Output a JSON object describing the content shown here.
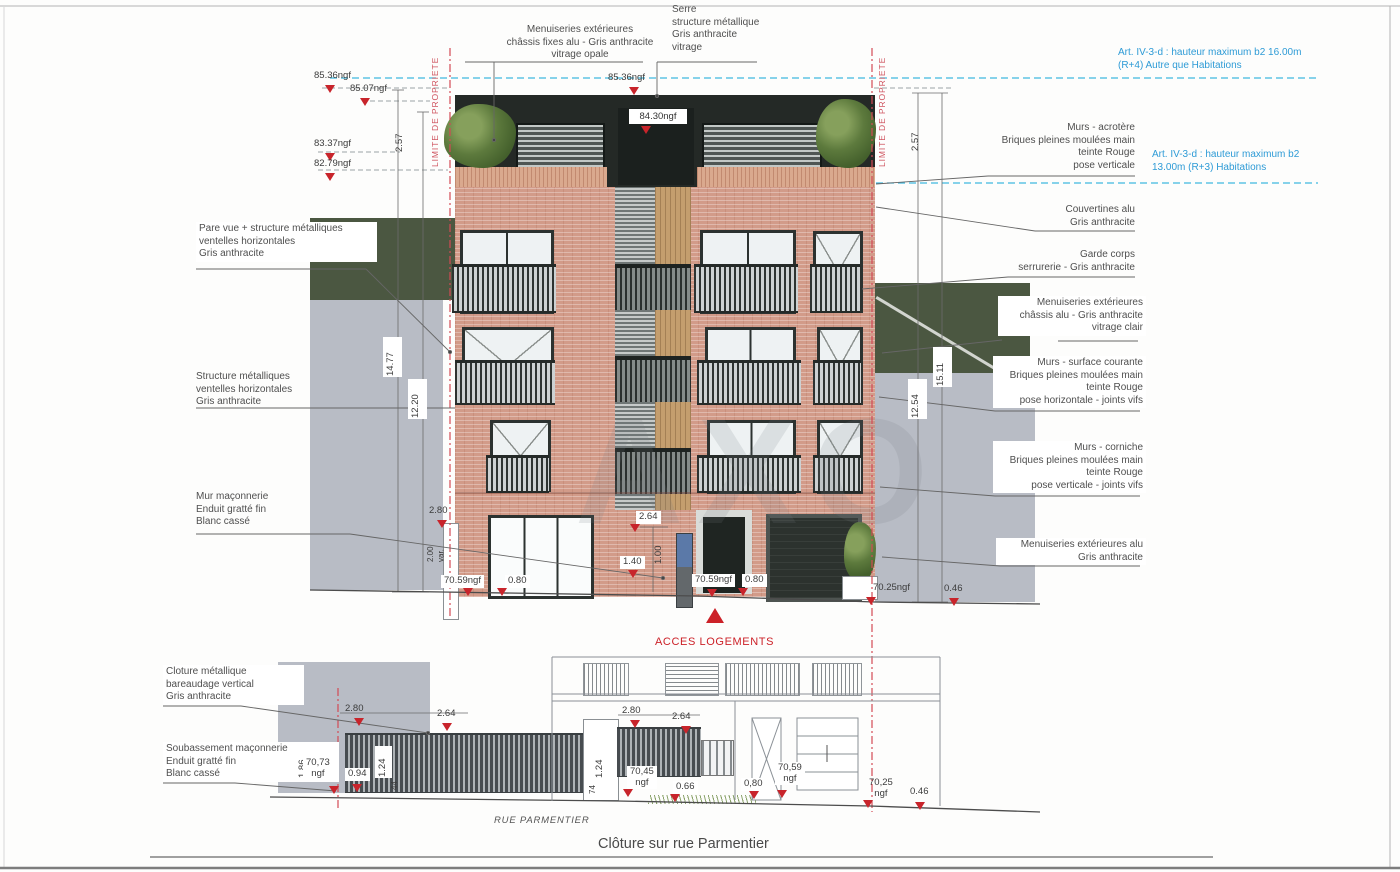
{
  "sheet": {
    "drawing_title": "Clôture sur rue Parmentier",
    "street_label": "RUE PARMENTIER",
    "access_label": "ACCES LOGEMENTS",
    "property_limit_label": "LIMITE DE PROPRIETE",
    "watermark": "AXO"
  },
  "regulatory": {
    "r4_rule": "Art. IV-3-d : hauteur maximum b2 16.00m\n(R+4) Autre que Habitations",
    "r3_rule": "Art. IV-3-d : hauteur maximum b2\n13.00m (R+3) Habitations"
  },
  "materials": {
    "pare_vue": "Pare vue + structure métalliques\nventelles horizontales\nGris anthracite",
    "structure_metallique": "Structure métalliques\nventelles horizontales\nGris anthracite",
    "mur_maconnerie": "Mur maçonnerie\nEnduit gratté fin\nBlanc cassé",
    "cloture_metallique": "Cloture métallique\nbareaudage vertical\nGris anthracite",
    "soubassement": "Soubassement maçonnerie\nEnduit gratté fin\nBlanc cassé",
    "menuiseries_opale": "Menuiseries extérieures\nchâssis fixes alu - Gris anthracite\nvitrage opale",
    "serre": "Serre\nstructure métallique\nGris anthracite\nvitrage",
    "murs_acrotere": "Murs - acrotère\nBriques pleines moulées main\nteinte Rouge\npose verticale",
    "couvertines": "Couvertines alu\nGris anthracite",
    "garde_corps": "Garde corps\nserrurerie - Gris anthracite",
    "menuiseries_clair": "Menuiseries extérieures\nchâssis alu - Gris anthracite\nvitrage clair",
    "murs_surface_courante": "Murs - surface courante\nBriques pleines moulées main\nteinte Rouge\npose horizontale - joints vifs",
    "murs_corniche": "Murs - corniche\nBriques pleines moulées main\nteinte Rouge\npose verticale - joints vifs",
    "menuiseries_alu": "Menuiseries extérieures alu\nGris anthracite"
  },
  "levels": {
    "lvl_85_36_left": "85.36ngf",
    "lvl_85_07": "85.07ngf",
    "lvl_83_37": "83.37ngf",
    "lvl_82_79": "82.79ngf",
    "lvl_85_36_center": "85.36ngf",
    "lvl_84_30": "84.30ngf",
    "lvl_70_59_left": "70.59ngf",
    "lvl_70_59_center": "70.59ngf",
    "lvl_70_25": "70.25ngf",
    "fence_70_73": "70,73\nngf",
    "fence_70_45": "70,45\nngf",
    "fence_70_59": "70,59\nngf",
    "fence_70_25": "70,25\nngf"
  },
  "dims": {
    "d2_57_left": "2.57",
    "d2_57_right": "2.57",
    "d14_77": "14.77",
    "d12_20": "12.20",
    "d15_11": "15.11",
    "d12_54": "12.54",
    "d2_80_wall": "2.80",
    "d2_00_var": "2.00\nvar.",
    "d0_80_door_left": "0.80",
    "d2_64_entry": "2.64",
    "d1_40": "1.40",
    "d1_00": "1.00",
    "d0_80_entry": "0.80",
    "d0_46_right": "0.46",
    "f2_80_a": "2.80",
    "f2_64_a": "2.64",
    "f2_80_b": "2.80",
    "f2_64_b": "2.64",
    "f1_86": "1.86",
    "f0_94": "0.94",
    "f1_24_a": "1.24",
    "f0_44": "44",
    "f1_24_b": "1.24",
    "f0_74": "74",
    "f0_66": "0.66",
    "f0_80": "0,80",
    "f0_46": "0.46"
  },
  "colors": {
    "brick": "#d29b89",
    "anthracite": "#242926",
    "context_gray": "#b8bcc5",
    "screen_green": "#4b5741",
    "marker_red": "#c8242b",
    "limit_pink": "#cf5560",
    "regulation_blue": "#2e9bd6"
  }
}
